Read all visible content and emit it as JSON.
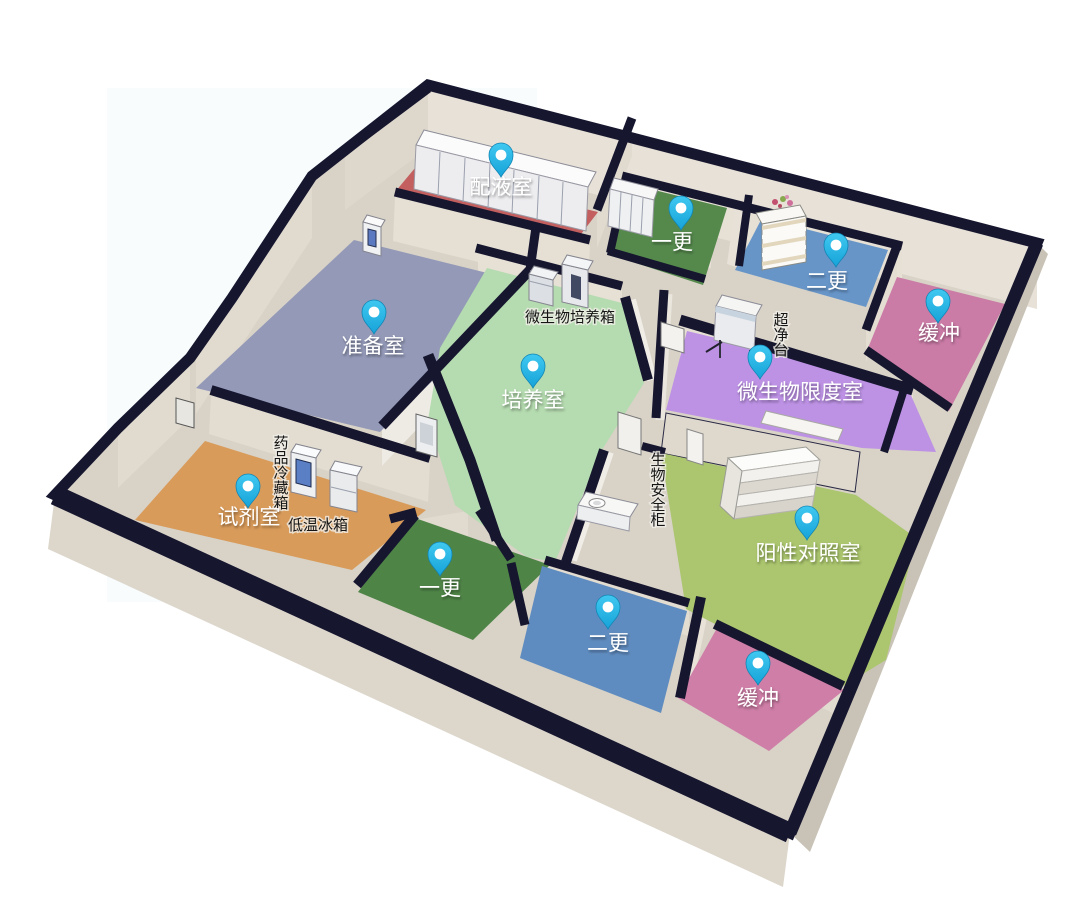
{
  "canvas": {
    "width": 1068,
    "height": 918,
    "background": "#ffffff"
  },
  "palette": {
    "wall_cap_navy": "#16162f",
    "wall_face_light": "#e7e1d8",
    "wall_face_mid": "#ded8cd",
    "wall_face_dark": "#c9c3b7",
    "base_slab": "#d8d2c7",
    "pin_fill_top": "#3fc8f0",
    "pin_fill_bottom": "#17a3d9",
    "pin_dot": "#ffffff",
    "room_label_color": "#ffffff",
    "equipment_label_color": "#151515"
  },
  "rooms": [
    {
      "id": "peiyeshi",
      "label": "配液室",
      "floor_color": "#c35f5e",
      "polygon": [
        [
          415,
          168
        ],
        [
          598,
          212
        ],
        [
          578,
          238
        ],
        [
          395,
          192
        ]
      ],
      "pin": {
        "x": 501,
        "y": 158
      },
      "label_pos": {
        "x": 501,
        "y": 194
      }
    },
    {
      "id": "yigeng-top",
      "label": "一更",
      "floor_color": "#55894c",
      "polygon": [
        [
          630,
          184
        ],
        [
          727,
          208
        ],
        [
          703,
          285
        ],
        [
          608,
          254
        ]
      ],
      "pin": {
        "x": 681,
        "y": 211
      },
      "label_pos": {
        "x": 672,
        "y": 249
      }
    },
    {
      "id": "ergeng-top",
      "label": "二更",
      "floor_color": "#6795c8",
      "polygon": [
        [
          762,
          218
        ],
        [
          888,
          250
        ],
        [
          866,
          307
        ],
        [
          735,
          270
        ]
      ],
      "pin": {
        "x": 836,
        "y": 248
      },
      "label_pos": {
        "x": 827,
        "y": 288
      }
    },
    {
      "id": "huanchong-top",
      "label": "缓冲",
      "floor_color": "#ca7ba6",
      "polygon": [
        [
          897,
          277
        ],
        [
          1005,
          304
        ],
        [
          949,
          411
        ],
        [
          866,
          353
        ]
      ],
      "pin": {
        "x": 938,
        "y": 304
      },
      "label_pos": {
        "x": 939,
        "y": 340
      }
    },
    {
      "id": "zhunbeishi",
      "label": "准备室",
      "floor_color": "#9399b7",
      "polygon": [
        [
          354,
          240
        ],
        [
          532,
          284
        ],
        [
          380,
          432
        ],
        [
          196,
          388
        ]
      ],
      "pin": {
        "x": 374,
        "y": 315
      },
      "label_pos": {
        "x": 373,
        "y": 353
      }
    },
    {
      "id": "peiyangshi",
      "label": "培养室",
      "floor_color": "#b5dbb0",
      "polygon": [
        [
          487,
          268
        ],
        [
          622,
          303
        ],
        [
          644,
          383
        ],
        [
          600,
          453
        ],
        [
          555,
          562
        ],
        [
          527,
          557
        ],
        [
          455,
          505
        ],
        [
          428,
          420
        ],
        [
          440,
          348
        ]
      ],
      "pin": {
        "x": 533,
        "y": 369
      },
      "label_pos": {
        "x": 533,
        "y": 407
      }
    },
    {
      "id": "weishengwu-xiandushi",
      "label": "微生物限度室",
      "floor_color": "#bd92e5",
      "polygon": [
        [
          687,
          331
        ],
        [
          906,
          384
        ],
        [
          936,
          452
        ],
        [
          862,
          448
        ],
        [
          666,
          410
        ]
      ],
      "pin": {
        "x": 760,
        "y": 360
      },
      "label_pos": {
        "x": 800,
        "y": 399
      }
    },
    {
      "id": "shijishi",
      "label": "试剂室",
      "floor_color": "#d99b5a",
      "polygon": [
        [
          205,
          441
        ],
        [
          426,
          510
        ],
        [
          352,
          570
        ],
        [
          135,
          520
        ]
      ],
      "pin": {
        "x": 248,
        "y": 489
      },
      "label_pos": {
        "x": 249,
        "y": 524
      }
    },
    {
      "id": "yigeng-bottom",
      "label": "一更",
      "floor_color": "#4f8447",
      "polygon": [
        [
          415,
          518
        ],
        [
          550,
          565
        ],
        [
          473,
          640
        ],
        [
          358,
          592
        ]
      ],
      "pin": {
        "x": 440,
        "y": 557
      },
      "label_pos": {
        "x": 440,
        "y": 595
      }
    },
    {
      "id": "yangxing-duizhaoshi",
      "label": "阳性对照室",
      "floor_color": "#abc66e",
      "polygon": [
        [
          661,
          453
        ],
        [
          856,
          495
        ],
        [
          916,
          538
        ],
        [
          886,
          660
        ],
        [
          843,
          686
        ],
        [
          715,
          624
        ],
        [
          686,
          609
        ]
      ],
      "pin": {
        "x": 807,
        "y": 521
      },
      "label_pos": {
        "x": 808,
        "y": 560
      }
    },
    {
      "id": "ergeng-bottom",
      "label": "二更",
      "floor_color": "#5f8cc0",
      "polygon": [
        [
          542,
          566
        ],
        [
          687,
          611
        ],
        [
          661,
          713
        ],
        [
          520,
          658
        ]
      ],
      "pin": {
        "x": 608,
        "y": 610
      },
      "label_pos": {
        "x": 608,
        "y": 650
      }
    },
    {
      "id": "huanchong-bottom",
      "label": "缓冲",
      "floor_color": "#cf7ea7",
      "polygon": [
        [
          717,
          628
        ],
        [
          844,
          690
        ],
        [
          769,
          751
        ],
        [
          678,
          698
        ]
      ],
      "pin": {
        "x": 758,
        "y": 666
      },
      "label_pos": {
        "x": 758,
        "y": 705
      }
    }
  ],
  "equipment_labels": [
    {
      "id": "weishengwu-peiyangxiang",
      "text": "微生物培养箱",
      "x": 570,
      "y": 322,
      "vertical": false
    },
    {
      "id": "chaojingtai",
      "text": "超净台",
      "x": 781,
      "y": 325,
      "vertical": true
    },
    {
      "id": "yaopin-lengcangxiang",
      "text": "药品冷藏箱",
      "x": 281,
      "y": 448,
      "vertical": true
    },
    {
      "id": "diwen-bingxiang",
      "text": "低温冰箱",
      "x": 318,
      "y": 530,
      "vertical": false
    },
    {
      "id": "shengwu-anquangui",
      "text": "生物安全柜",
      "x": 658,
      "y": 465,
      "vertical": true
    }
  ]
}
